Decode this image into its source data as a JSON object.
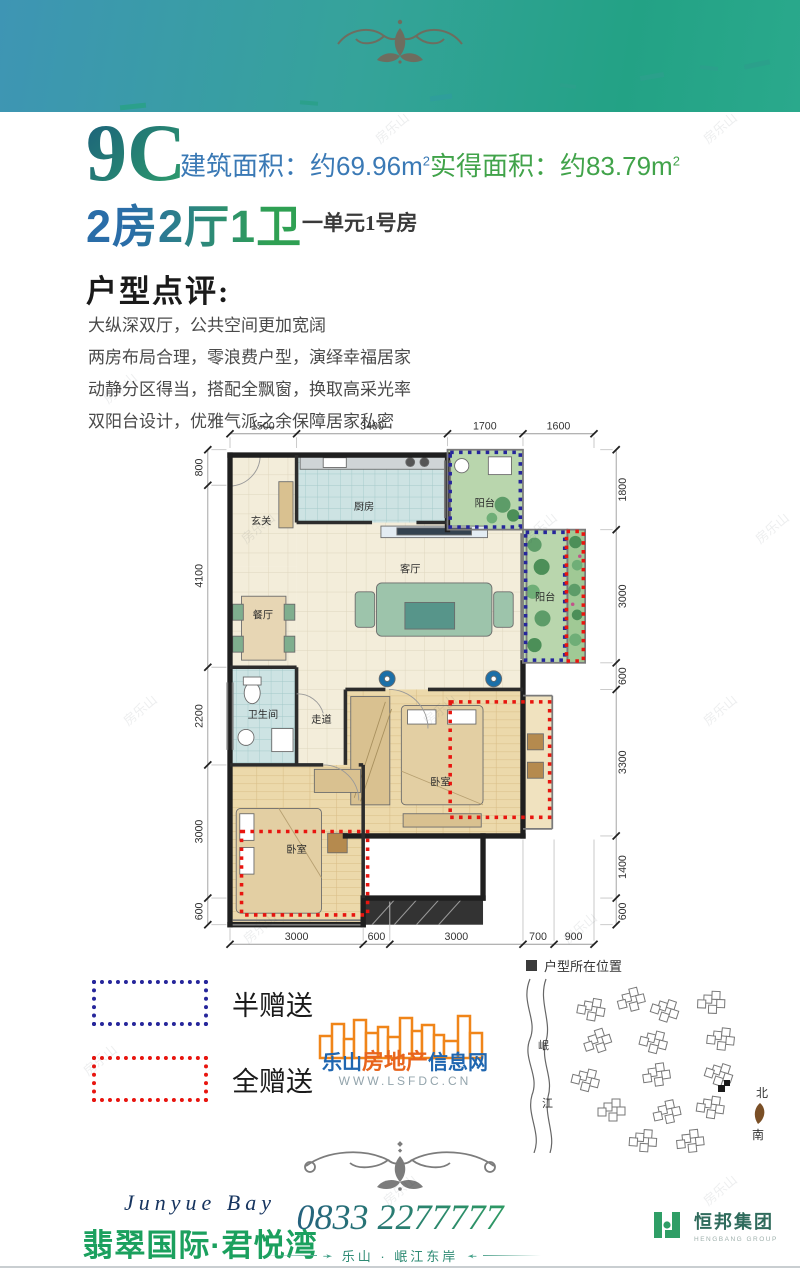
{
  "watermark": "房乐山",
  "header": {
    "unit_code": "9C",
    "built_area_text": "建筑面积：约69.96m",
    "built_area_sup": "2",
    "actual_area_text": "实得面积：约83.79m",
    "actual_area_sup": "2",
    "rooms_spec": "2房2厅1卫",
    "unit_location": "一单元1号房"
  },
  "review": {
    "title": "户型点评:",
    "lines": [
      "大纵深双厅，公共空间更加宽阔",
      "两房布局合理，零浪费户型，演绎幸福居家",
      "动静分区得当，搭配全飘窗，换取高采光率",
      "双阳台设计，优雅气派之余保障居家私密"
    ]
  },
  "floorplan": {
    "dims_top": [
      "1500",
      "3400",
      "1700",
      "1600"
    ],
    "dims_left": [
      "800",
      "4100",
      "2200",
      "3000",
      "600"
    ],
    "dims_right": [
      "1800",
      "3000",
      "600",
      "3300",
      "1400",
      "600"
    ],
    "dims_bottom": [
      "3000",
      "600",
      "3000",
      "700",
      "900"
    ],
    "rooms": {
      "entry": "玄关",
      "kitchen": "厨房",
      "balcony_top": "阳台",
      "living": "客厅",
      "balcony_right": "阳台",
      "dining": "餐厅",
      "bath": "卫生间",
      "corridor": "走道",
      "bedroom_master": "卧室",
      "bedroom_second": "卧室"
    }
  },
  "legend": {
    "half_label": "半赠送",
    "full_label": "全赠送",
    "half_color": "#26269b",
    "full_color": "#e8150f"
  },
  "lsfdc": {
    "part1": "乐山",
    "part2": "房地产",
    "part3": "信息网",
    "url": "WWW.LSFDC.CN"
  },
  "siteplan": {
    "title": "户型所在位置",
    "river_char_1": "岷",
    "river_char_2": "江",
    "compass_north": "北",
    "compass_south": "南"
  },
  "footer": {
    "brand_en": "Junyue Bay",
    "brand_cn": "翡翠国际·君悦湾",
    "phone": "0833 2277777",
    "slogan": "乐山 · 岷江东岸",
    "group_cn": "恒邦集团",
    "group_en": "HENGBANG GROUP"
  },
  "colors": {
    "band_blue": "#3e95b4",
    "band_green": "#23a285",
    "accent_blue": "#2a6da8",
    "accent_green": "#2fa053",
    "half_gift_blue": "#26269b",
    "full_gift_red": "#e8150f"
  }
}
